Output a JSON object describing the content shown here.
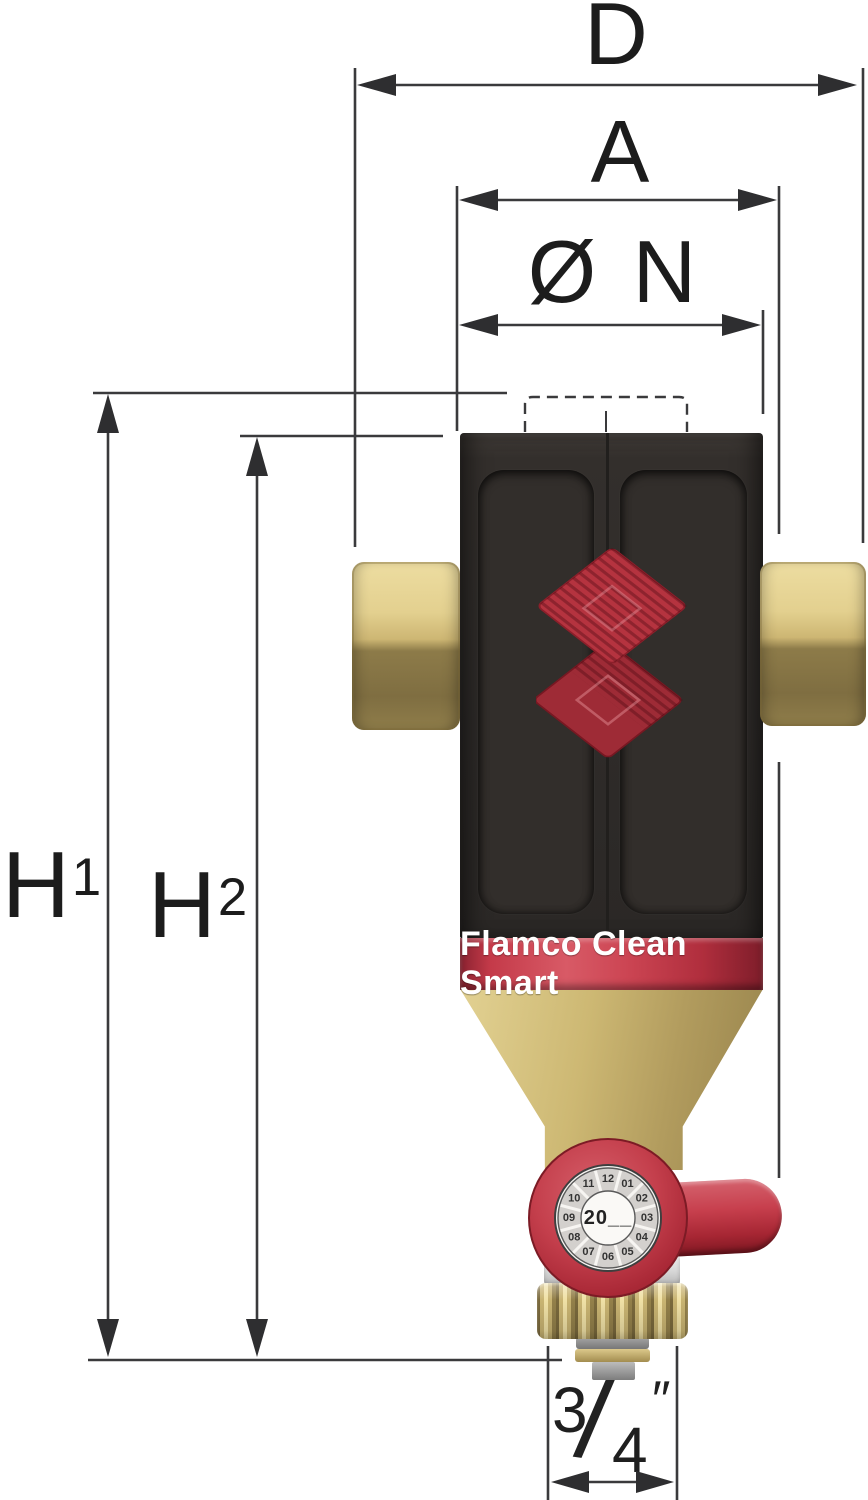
{
  "meta": {
    "product_name": "Flamco Clean Smart",
    "drawing_type": "dimensional diagram of dirt separator with drain valve"
  },
  "dimension_labels": {
    "overall_width": "D",
    "width_with_handle": "A",
    "body_diameter": "Ø N",
    "height1_base": "H",
    "height1_sup": "1",
    "height2_base": "H",
    "height2_sup": "2",
    "drain_numerator": "3",
    "drain_denominator": "4",
    "drain_unit": "″"
  },
  "product": {
    "band_text": "Flamco Clean Smart",
    "dial": {
      "center_text": "20__",
      "months": [
        "12",
        "01",
        "02",
        "03",
        "04",
        "05",
        "06",
        "07",
        "08",
        "09",
        "10",
        "11"
      ]
    }
  },
  "colors": {
    "brand_red": "#bf3645",
    "band_red": "#c43a49",
    "body_black": "#2e2b29",
    "brass": "#cdb873",
    "dial_face": "#f7f5f2",
    "dimension_line": "#3a3a3c",
    "background": "#ffffff"
  }
}
